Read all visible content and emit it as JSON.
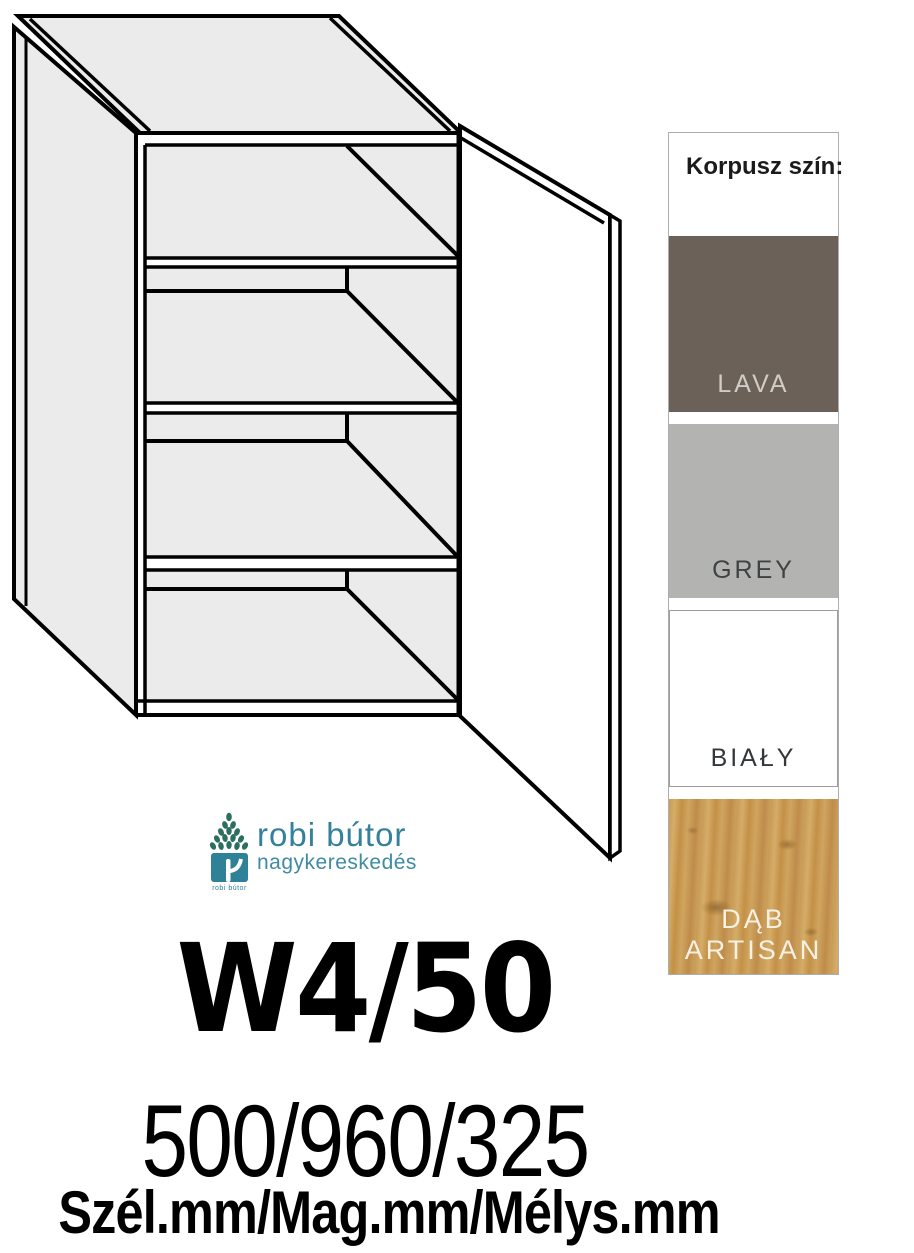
{
  "product": {
    "code": "W4/50",
    "dimensions": "500/960/325",
    "dimensions_caption": "Szél.mm/Mag.mm/Mélys.mm"
  },
  "logo": {
    "brand": "robi bútor",
    "subtitle": "nagykereskedés",
    "icon_caption": "robi bútor",
    "accent_color": "#35809a",
    "leaf_color": "#2a6f60"
  },
  "swatch_panel": {
    "title": "Korpusz szín:",
    "swatches": [
      {
        "name": "LAVA",
        "color": "#6b6158",
        "label_color": "#d2ccc6"
      },
      {
        "name": "GREY",
        "color": "#b3b4b2",
        "label_color": "#3f4245"
      },
      {
        "name": "BIAŁY",
        "color": "#ffffff",
        "label_color": "#35383b"
      },
      {
        "name": "DĄB\nARTISAN",
        "color": "#c89b54",
        "label_color": "#f7f1e4"
      }
    ]
  },
  "drawing": {
    "line_color": "#000000",
    "panel_fill": "#ebebeb",
    "door_fill": "#ffffff"
  }
}
